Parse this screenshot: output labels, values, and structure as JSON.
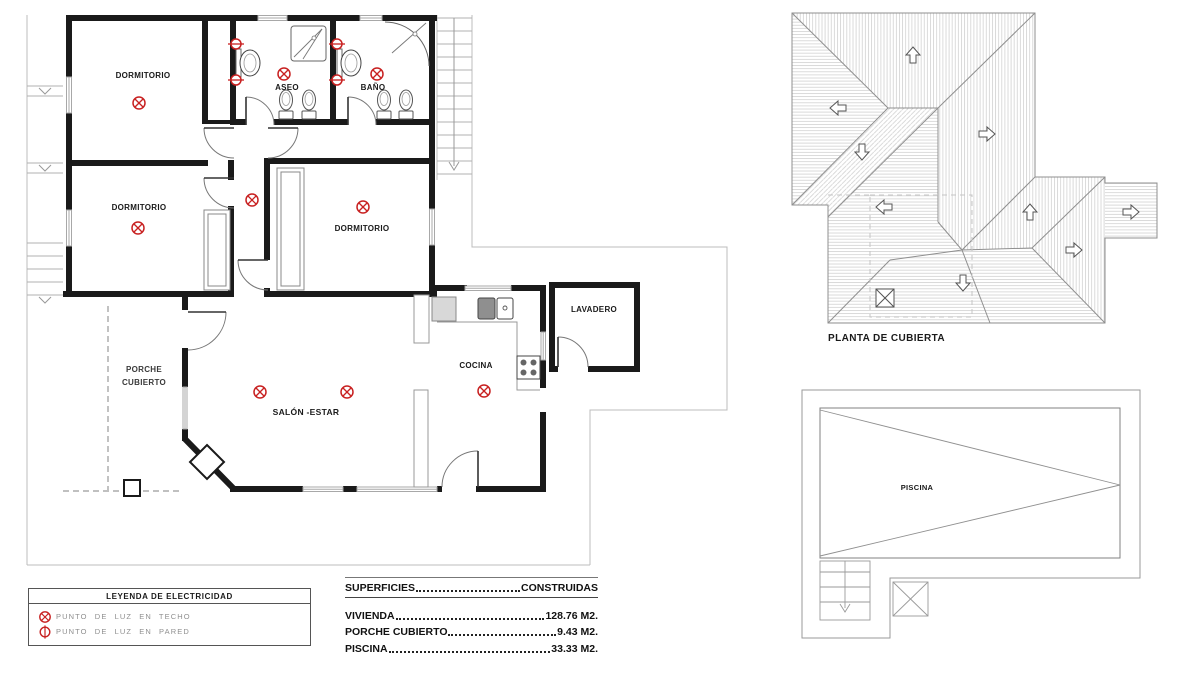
{
  "palette": {
    "wall": "#1a1a1a",
    "drawing_gray": "#909090",
    "site_gray": "#bcbcbc",
    "hatch_gray": "#d2d2d2",
    "red": "#c82121",
    "text": "#1a1a1a",
    "muted_text": "#8f8f8f"
  },
  "floor_plan": {
    "rooms": [
      {
        "label": "DORMITORIO"
      },
      {
        "label": "ASEO"
      },
      {
        "label": "BAÑO"
      },
      {
        "label": "DORMITORIO"
      },
      {
        "label": "DORMITORIO"
      },
      {
        "label": "SALÓN -ESTAR"
      },
      {
        "label": "COCINA"
      },
      {
        "label": "LAVADERO"
      },
      {
        "label": "PORCHE",
        "label2": "CUBIERTO"
      }
    ],
    "symbols": {
      "ceiling_lights": 9,
      "wall_lights": 4
    }
  },
  "roof_plan": {
    "caption": "PLANTA DE CUBIERTA"
  },
  "pool_plan": {
    "label": "PISCINA"
  },
  "legend": {
    "title": "LEYENDA DE ELECTRICIDAD",
    "items": [
      {
        "icon": "ceiling-light-icon",
        "label": "PUNTO DE LUZ EN TECHO"
      },
      {
        "icon": "wall-light-icon",
        "label": "PUNTO DE LUZ EN PARED"
      }
    ]
  },
  "areas_table": {
    "header_left": "SUPERFICIES",
    "header_right": "CONSTRUIDAS",
    "rows": [
      {
        "label": "VIVIENDA",
        "value": "128.76 M2."
      },
      {
        "label": "PORCHE CUBIERTO",
        "value": "9.43 M2."
      },
      {
        "label": "PISCINA",
        "value": "33.33 M2."
      }
    ]
  }
}
